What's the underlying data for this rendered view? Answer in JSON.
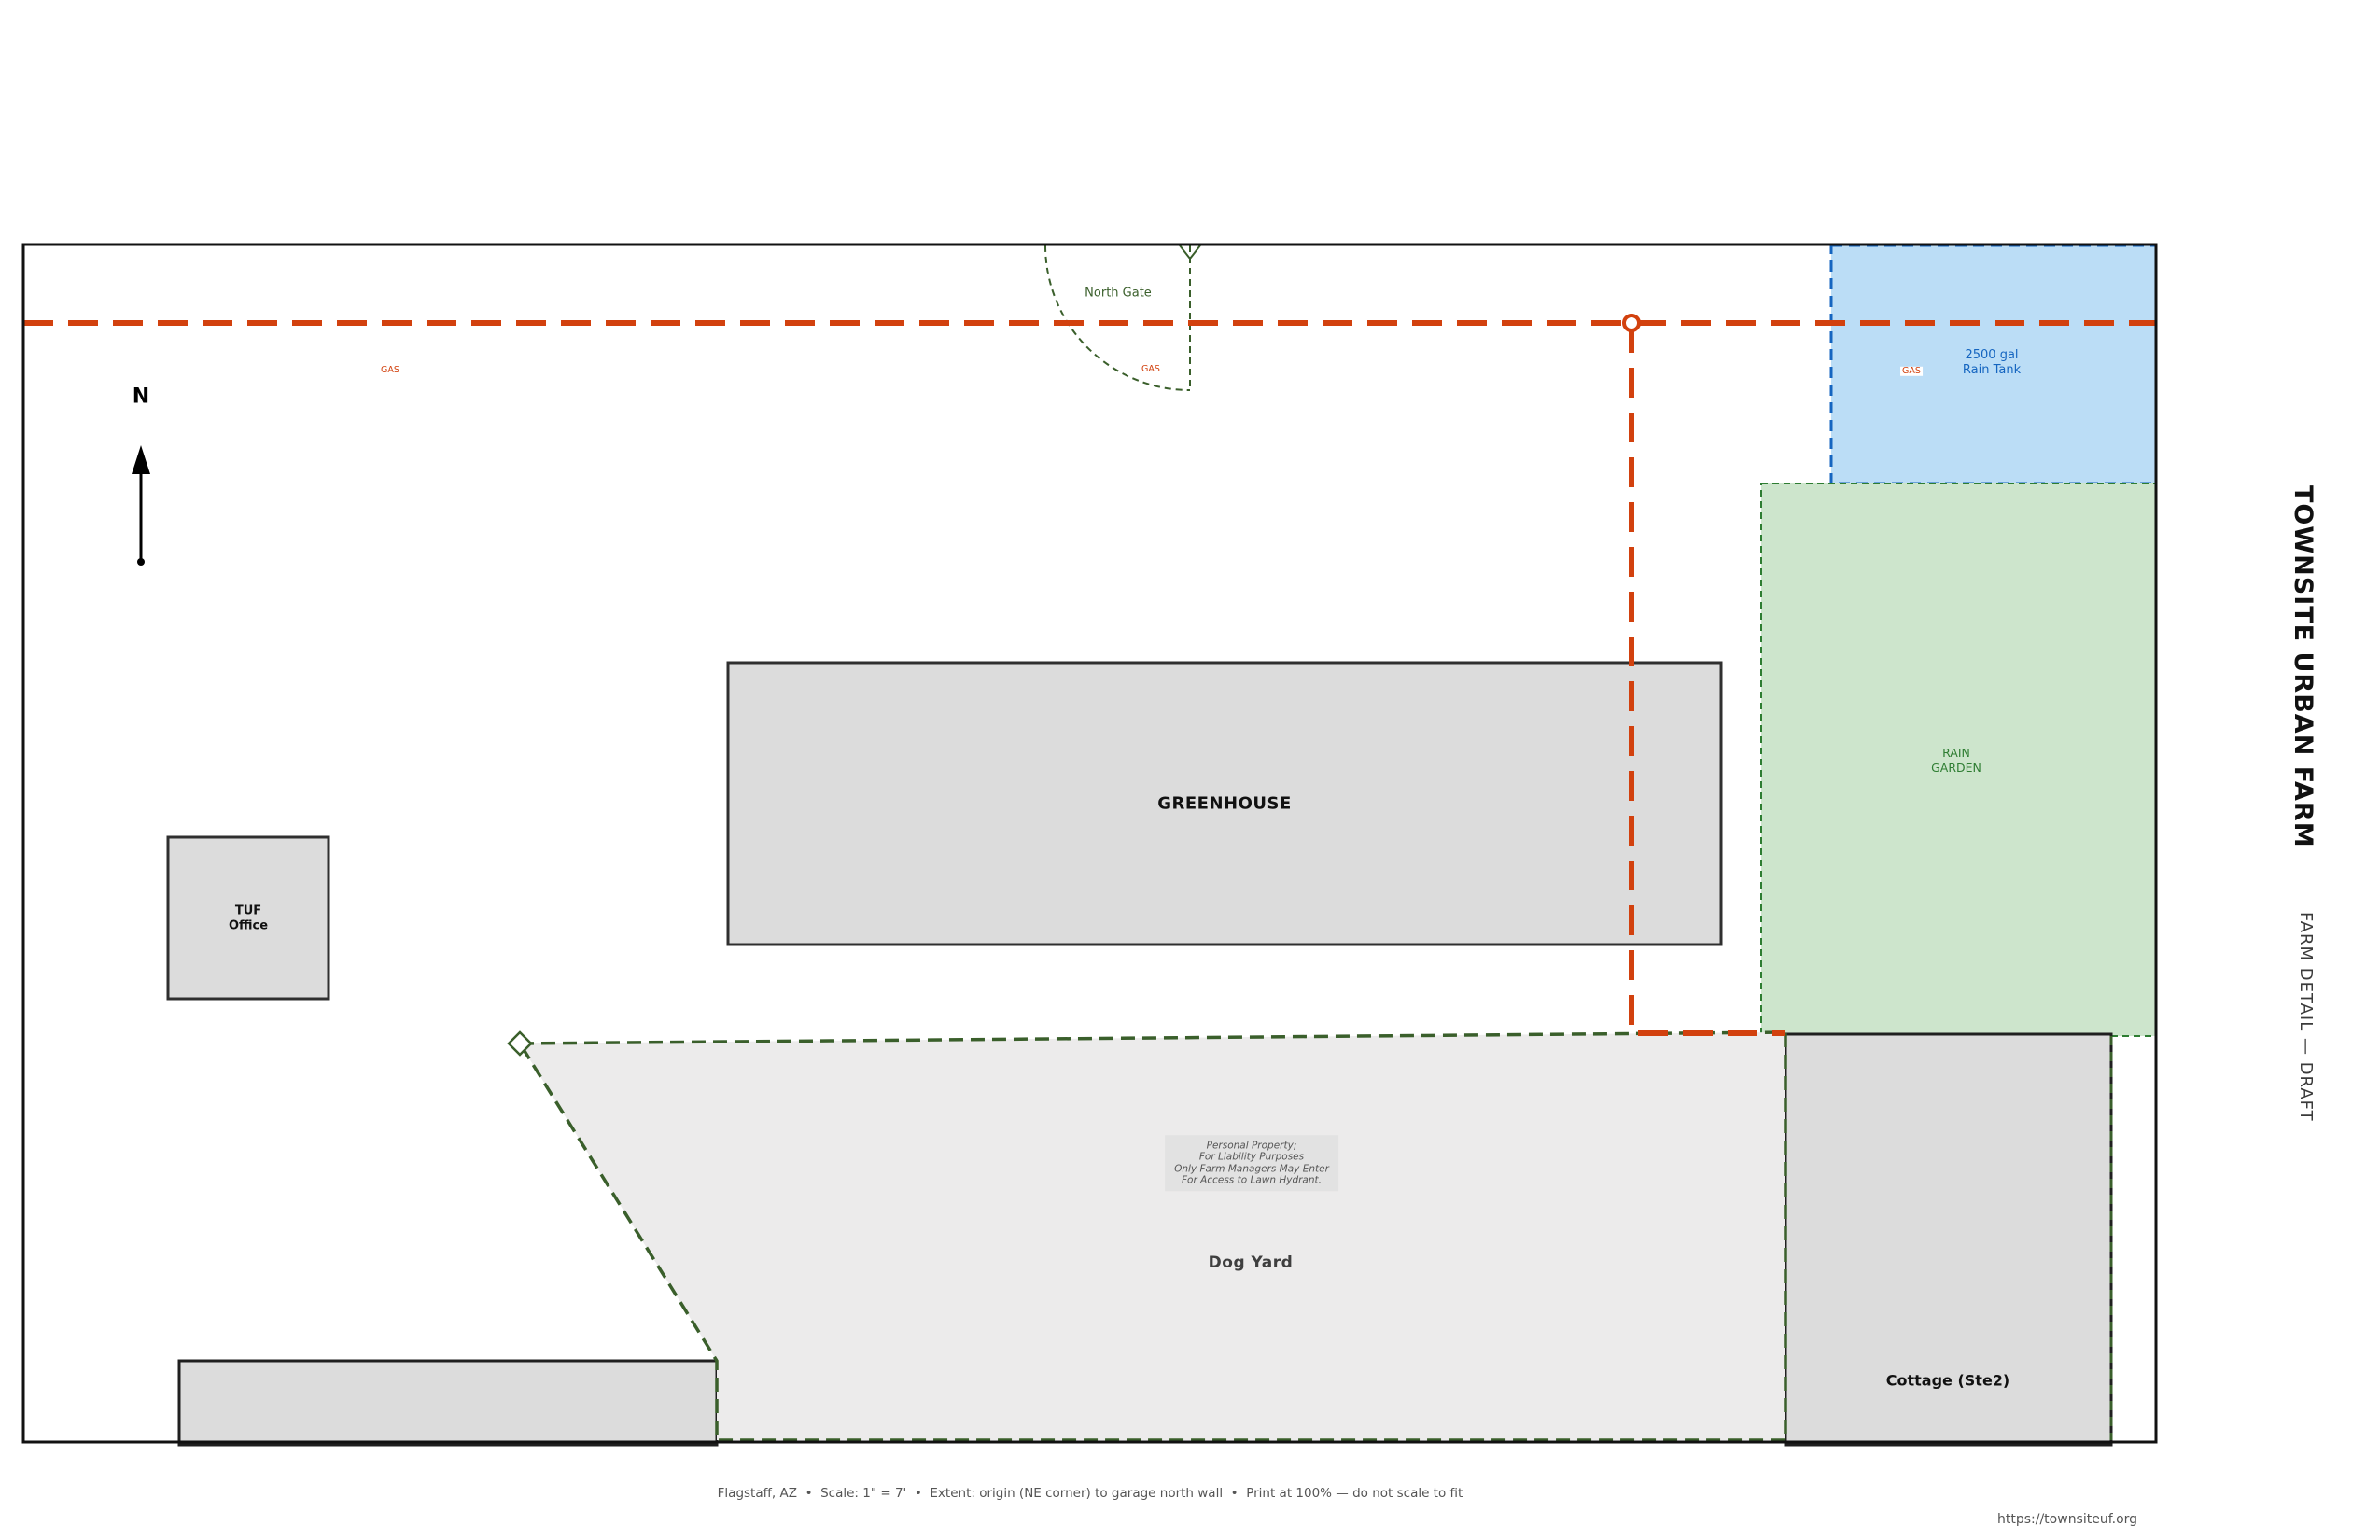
{
  "title_block": {
    "farm_name": "TOWNSITE URBAN FARM",
    "sheet_title": "FARM DETAIL — DRAFT",
    "website": "https://townsiteuf.org"
  },
  "footer": {
    "caption": "Flagstaff, AZ  •  Scale: 1\" = 7'  •  Extent: origin (NE corner) to garage north wall  •  Print at 100% — do not scale to fit"
  },
  "compass": {
    "north_label": "N"
  },
  "plan": {
    "north_gate": {
      "label": "North Gate"
    },
    "gas_line": {
      "labels": [
        "GAS",
        "GAS",
        "GAS"
      ]
    },
    "rain_tank": {
      "line1": "2500 gal",
      "line2": "Rain Tank"
    },
    "rain_garden": {
      "line1": "RAIN",
      "line2": "GARDEN"
    },
    "greenhouse": {
      "label": "GREENHOUSE"
    },
    "tuf_office": {
      "line1": "TUF",
      "line2": "Office"
    },
    "dog_yard": {
      "label": "Dog Yard",
      "note_lines": [
        "Personal Property;",
        "For Liability Purposes",
        "Only Farm Managers May Enter",
        "For Access to Lawn Hydrant."
      ]
    },
    "cottage": {
      "label": "Cottage (Ste2)"
    }
  },
  "colors": {
    "gas_line_red": "#D2410E",
    "fence_green": "#3A5F2B",
    "rain_tank_fill": "#BBDDF6",
    "rain_tank_stroke": "#1565C0",
    "rain_garden_fill": "#CDE5CC",
    "rain_garden_stroke": "#2E7D32",
    "building_fill": "#DCDCDC",
    "dog_yard_fill": "#ECEBEB"
  }
}
